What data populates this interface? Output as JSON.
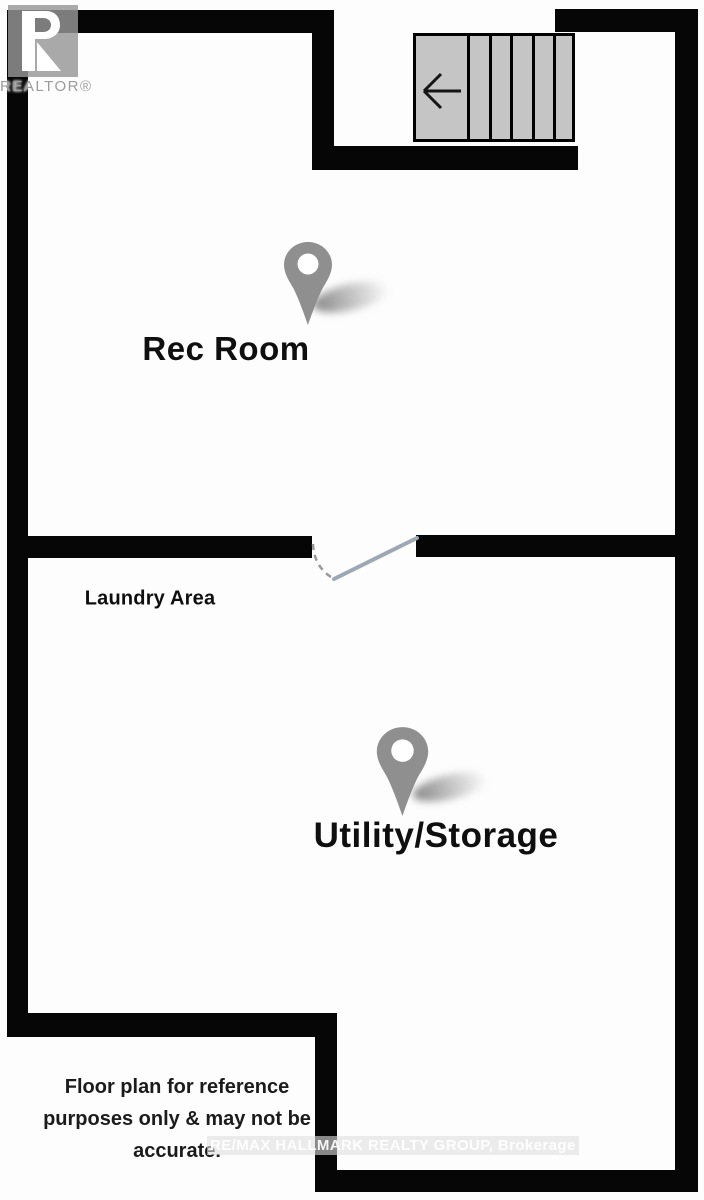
{
  "title": "Basement floor plan",
  "branding": {
    "logo_letter_r": "R",
    "logo_wordmark": "REALTOR®"
  },
  "rooms": {
    "rec_room": {
      "label": "Rec Room"
    },
    "laundry": {
      "label": "Laundry Area"
    },
    "utility": {
      "label": "Utility/Storage"
    }
  },
  "stairs": {
    "icon": "left-arrow-icon",
    "tread_count": 5
  },
  "door": {
    "type": "swing-door"
  },
  "disclaimer": {
    "line1": "Floor plan for reference",
    "line2": "purposes only & may not be",
    "line3": "accurate."
  },
  "watermark": {
    "text": "RE/MAX HALLMARK REALTY GROUP, Brokerage"
  },
  "colors": {
    "wall": "#060606",
    "stair_fill": "#c5c5c5",
    "pin": "#8f8f8f",
    "door_leaf": "#9fa8b2",
    "label_text": "#0f0f0f",
    "logo_gray": "#9c9c9c"
  }
}
